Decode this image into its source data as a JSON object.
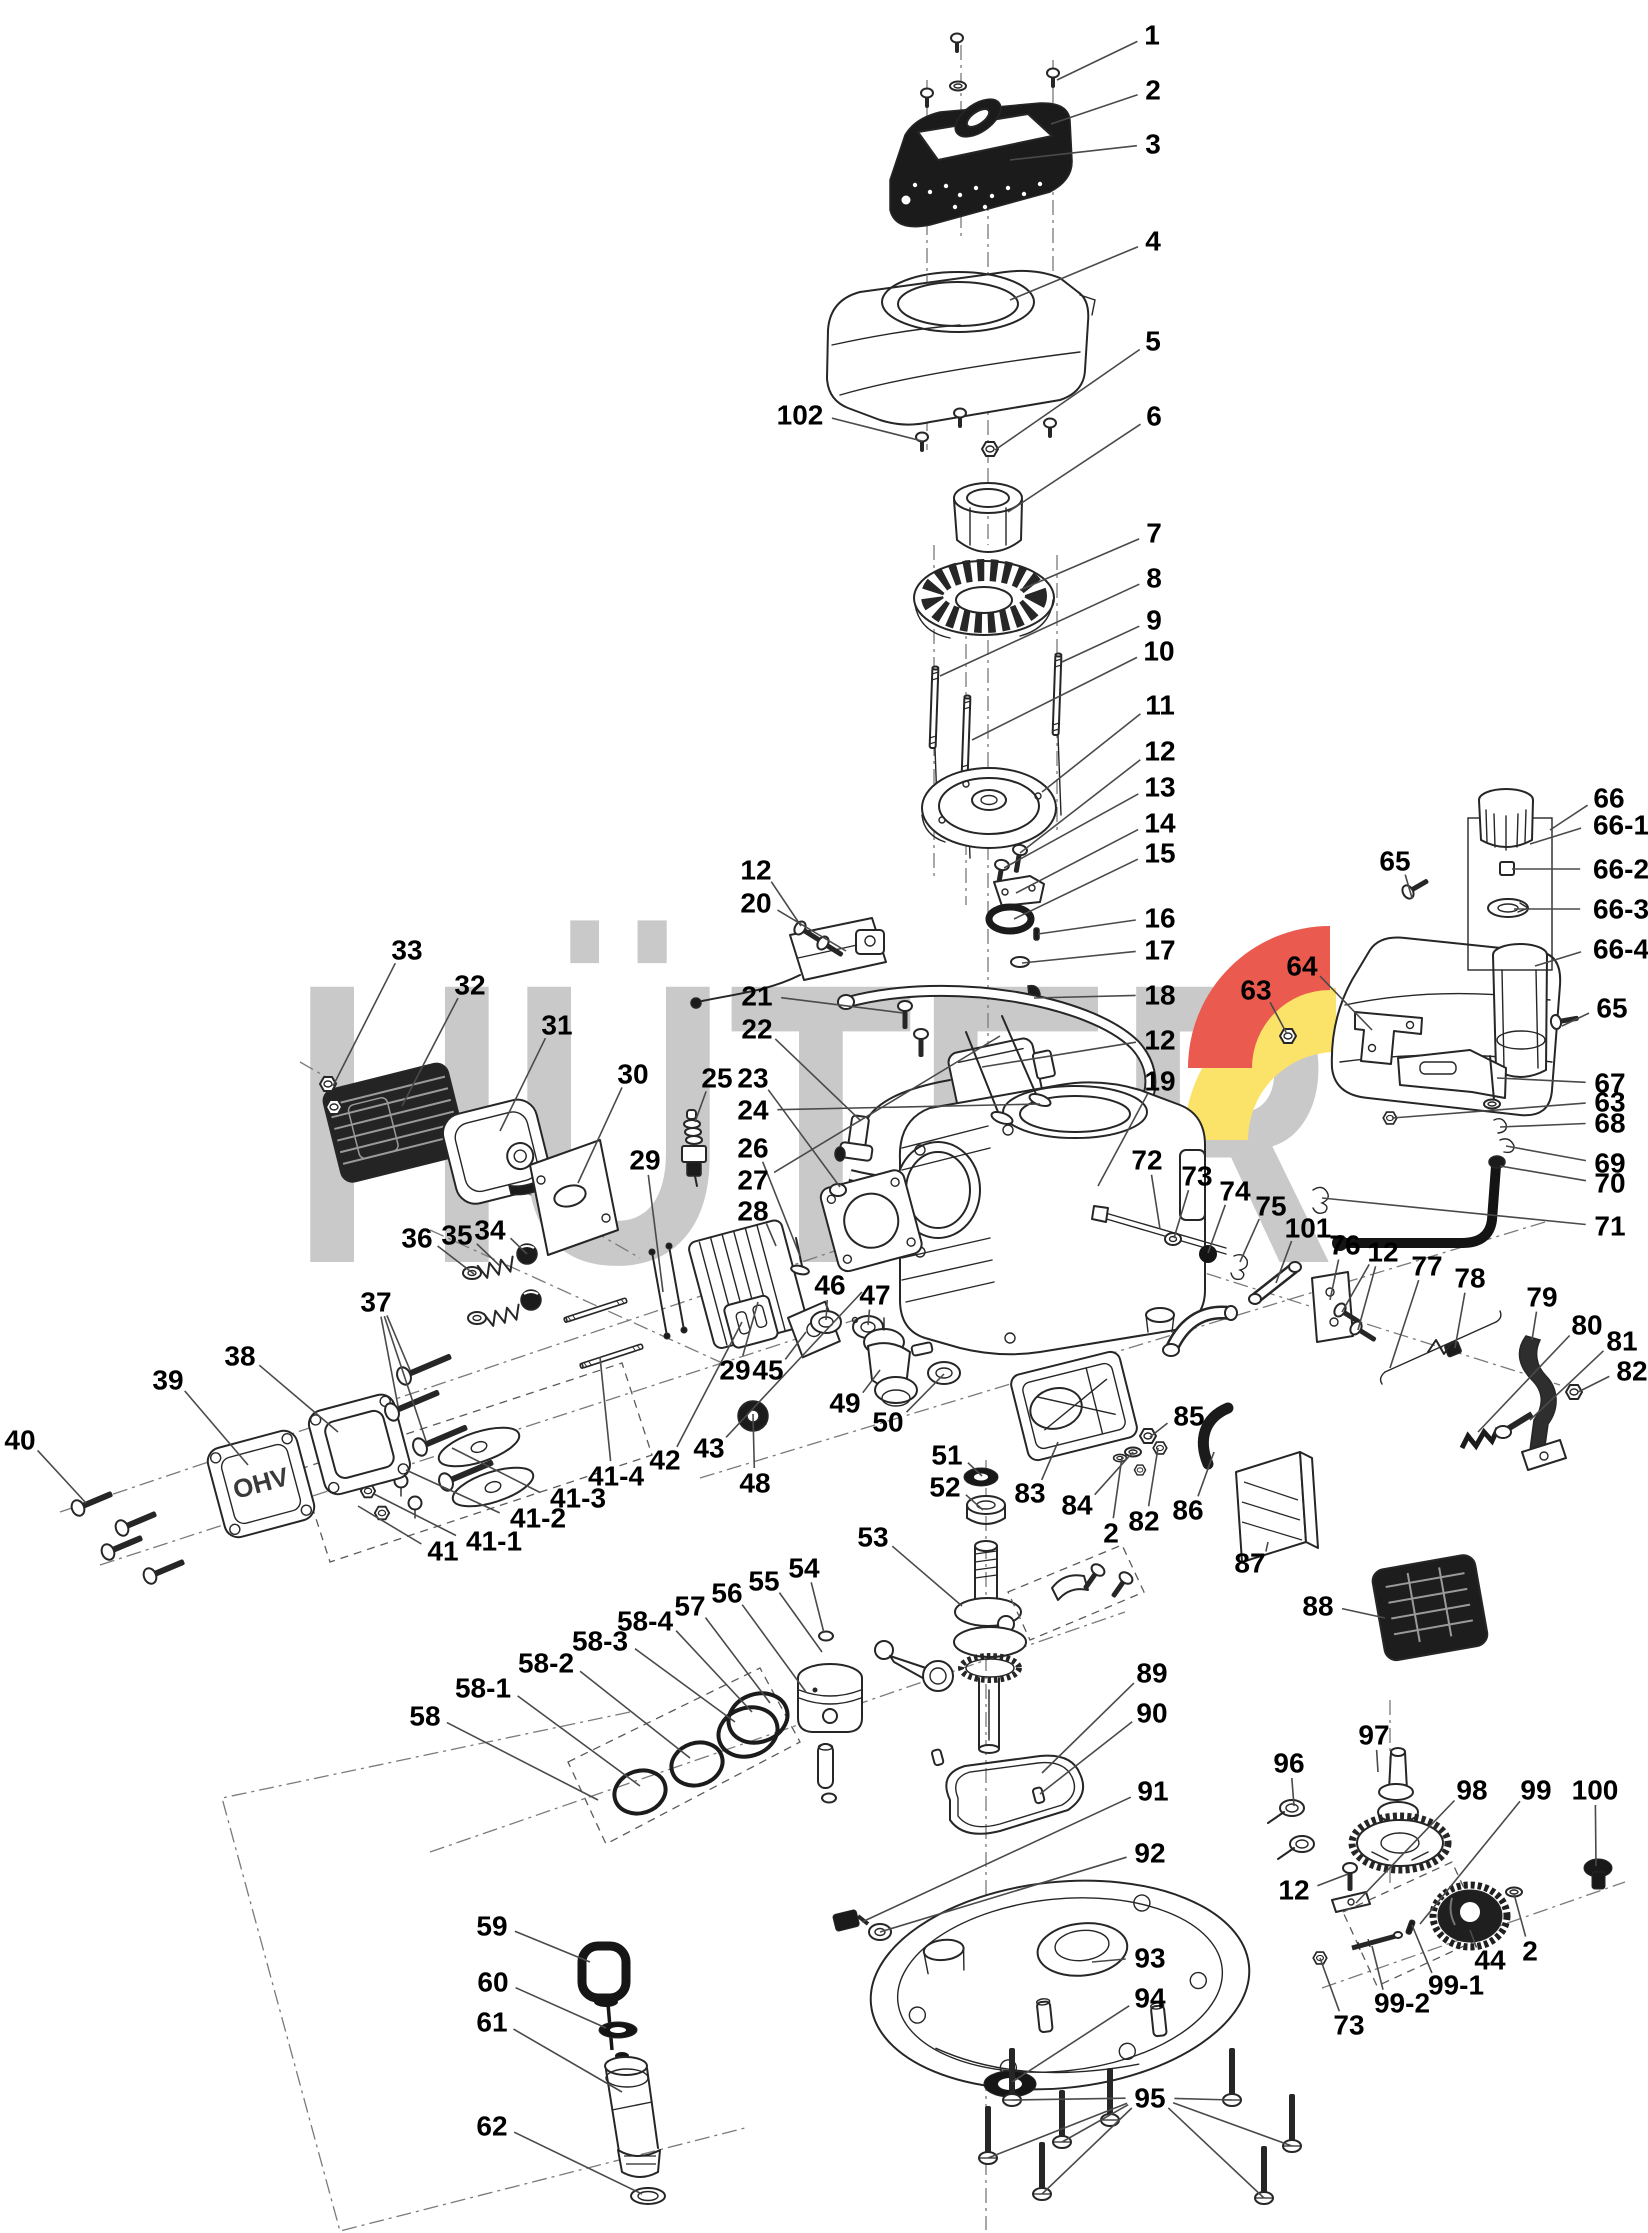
{
  "figure": {
    "type": "exploded-parts-diagram",
    "subject": "engine"
  },
  "watermark": {
    "text": "HÜTER",
    "gray": "#c9c9c9",
    "red": "#ea5a4f",
    "yellow": "#fbe36a"
  },
  "cover_emboss": "OHV",
  "callouts": [
    {
      "n": "1",
      "x": 1152,
      "y": 35,
      "t": [
        [
          1057,
          80
        ]
      ]
    },
    {
      "n": "2",
      "x": 1153,
      "y": 90,
      "t": [
        [
          1051,
          124
        ]
      ]
    },
    {
      "n": "3",
      "x": 1153,
      "y": 144,
      "t": [
        [
          1010,
          160
        ]
      ]
    },
    {
      "n": "4",
      "x": 1153,
      "y": 241,
      "t": [
        [
          1010,
          300
        ]
      ]
    },
    {
      "n": "5",
      "x": 1153,
      "y": 341,
      "t": [
        [
          995,
          450
        ]
      ]
    },
    {
      "n": "6",
      "x": 1154,
      "y": 416,
      "t": [
        [
          1008,
          512
        ]
      ]
    },
    {
      "n": "7",
      "x": 1154,
      "y": 533,
      "t": [
        [
          1020,
          590
        ]
      ]
    },
    {
      "n": "8",
      "x": 1154,
      "y": 578,
      "t": [
        [
          940,
          676
        ]
      ]
    },
    {
      "n": "9",
      "x": 1154,
      "y": 620,
      "t": [
        [
          1062,
          662
        ]
      ]
    },
    {
      "n": "10",
      "x": 1159,
      "y": 651,
      "t": [
        [
          972,
          740
        ]
      ]
    },
    {
      "n": "11",
      "x": 1160,
      "y": 705,
      "t": [
        [
          1042,
          792
        ]
      ]
    },
    {
      "n": "12",
      "x": 1160,
      "y": 751,
      "t": [
        [
          1020,
          853
        ]
      ]
    },
    {
      "n": "13",
      "x": 1160,
      "y": 787,
      "t": [
        [
          1004,
          868
        ]
      ]
    },
    {
      "n": "14",
      "x": 1160,
      "y": 823,
      "t": [
        [
          1016,
          893
        ]
      ]
    },
    {
      "n": "15",
      "x": 1160,
      "y": 853,
      "t": [
        [
          1014,
          919
        ]
      ]
    },
    {
      "n": "16",
      "x": 1160,
      "y": 918,
      "t": [
        [
          1038,
          934
        ]
      ]
    },
    {
      "n": "17",
      "x": 1160,
      "y": 950,
      "t": [
        [
          1022,
          963
        ]
      ]
    },
    {
      "n": "18",
      "x": 1160,
      "y": 995,
      "t": [
        [
          1034,
          998
        ]
      ]
    },
    {
      "n": "12",
      "x": 1160,
      "y": 1040,
      "t": [
        [
          982,
          1067
        ]
      ]
    },
    {
      "n": "19",
      "x": 1160,
      "y": 1081,
      "t": [
        [
          1098,
          1186
        ]
      ]
    },
    {
      "n": "102",
      "x": 800,
      "y": 415,
      "t": [
        [
          922,
          441
        ]
      ]
    },
    {
      "n": "33",
      "x": 407,
      "y": 950,
      "t": [
        [
          333,
          1086
        ]
      ]
    },
    {
      "n": "32",
      "x": 470,
      "y": 985,
      "t": [
        [
          402,
          1106
        ]
      ]
    },
    {
      "n": "31",
      "x": 557,
      "y": 1025,
      "t": [
        [
          500,
          1131
        ]
      ]
    },
    {
      "n": "30",
      "x": 633,
      "y": 1074,
      "t": [
        [
          578,
          1183
        ]
      ]
    },
    {
      "n": "25",
      "x": 717,
      "y": 1078,
      "t": [
        [
          695,
          1122
        ]
      ]
    },
    {
      "n": "23",
      "x": 753,
      "y": 1078,
      "t": [
        [
          840,
          1187
        ]
      ]
    },
    {
      "n": "12",
      "x": 756,
      "y": 870,
      "t": [
        [
          801,
          926
        ]
      ]
    },
    {
      "n": "20",
      "x": 756,
      "y": 903,
      "t": [
        [
          846,
          951
        ]
      ]
    },
    {
      "n": "21",
      "x": 757,
      "y": 996,
      "t": [
        [
          903,
          1013
        ]
      ]
    },
    {
      "n": "22",
      "x": 757,
      "y": 1029,
      "t": [
        [
          861,
          1121
        ]
      ]
    },
    {
      "n": "24",
      "x": 753,
      "y": 1110,
      "t": [
        [
          1040,
          1104
        ]
      ]
    },
    {
      "n": "26",
      "x": 753,
      "y": 1148,
      "t": [
        [
          800,
          1256
        ]
      ]
    },
    {
      "n": "27",
      "x": 753,
      "y": 1180,
      "t": [
        [
          1000,
          1036
        ]
      ]
    },
    {
      "n": "28",
      "x": 753,
      "y": 1211,
      "t": [
        [
          776,
          1246
        ]
      ]
    },
    {
      "n": "29",
      "x": 645,
      "y": 1160,
      "t": [
        [
          663,
          1292
        ]
      ]
    },
    {
      "n": "36",
      "x": 417,
      "y": 1238,
      "t": [
        [
          474,
          1274
        ]
      ]
    },
    {
      "n": "35",
      "x": 457,
      "y": 1235,
      "t": [
        [
          500,
          1266
        ]
      ]
    },
    {
      "n": "34",
      "x": 490,
      "y": 1230,
      "t": [
        [
          527,
          1254
        ]
      ]
    },
    {
      "n": "37",
      "x": 376,
      "y": 1302,
      "t": [
        [
          410,
          1370
        ],
        [
          398,
          1406
        ],
        [
          426,
          1441
        ]
      ]
    },
    {
      "n": "38",
      "x": 240,
      "y": 1356,
      "t": [
        [
          338,
          1432
        ]
      ]
    },
    {
      "n": "39",
      "x": 168,
      "y": 1380,
      "t": [
        [
          248,
          1465
        ]
      ]
    },
    {
      "n": "40",
      "x": 20,
      "y": 1440,
      "t": [
        [
          86,
          1503
        ]
      ]
    },
    {
      "n": "41",
      "x": 443,
      "y": 1551,
      "t": [
        [
          358,
          1506
        ]
      ]
    },
    {
      "n": "41-1",
      "x": 494,
      "y": 1541,
      "t": [
        [
          374,
          1494
        ]
      ]
    },
    {
      "n": "41-2",
      "x": 538,
      "y": 1518,
      "t": [
        [
          406,
          1470
        ]
      ]
    },
    {
      "n": "41-3",
      "x": 578,
      "y": 1498,
      "t": [
        [
          452,
          1448
        ]
      ]
    },
    {
      "n": "41-4",
      "x": 616,
      "y": 1476,
      "t": [
        [
          600,
          1357
        ]
      ]
    },
    {
      "n": "42",
      "x": 665,
      "y": 1460,
      "t": [
        [
          742,
          1322
        ]
      ]
    },
    {
      "n": "43",
      "x": 709,
      "y": 1448,
      "t": [
        [
          862,
          1292
        ]
      ]
    },
    {
      "n": "29",
      "x": 735,
      "y": 1370,
      "t": [
        [
          758,
          1302
        ]
      ]
    },
    {
      "n": "45",
      "x": 768,
      "y": 1370,
      "t": [
        [
          806,
          1332
        ]
      ]
    },
    {
      "n": "46",
      "x": 830,
      "y": 1285,
      "t": [
        [
          826,
          1320
        ]
      ]
    },
    {
      "n": "47",
      "x": 875,
      "y": 1295,
      "t": [
        [
          868,
          1325
        ]
      ]
    },
    {
      "n": "48",
      "x": 755,
      "y": 1483,
      "t": [
        [
          753,
          1414
        ]
      ]
    },
    {
      "n": "49",
      "x": 845,
      "y": 1403,
      "t": [
        [
          880,
          1370
        ]
      ]
    },
    {
      "n": "50",
      "x": 888,
      "y": 1422,
      "t": [
        [
          944,
          1374
        ]
      ]
    },
    {
      "n": "51",
      "x": 947,
      "y": 1455,
      "t": [
        [
          982,
          1476
        ]
      ]
    },
    {
      "n": "52",
      "x": 945,
      "y": 1487,
      "t": [
        [
          983,
          1510
        ]
      ]
    },
    {
      "n": "53",
      "x": 873,
      "y": 1537,
      "t": [
        [
          962,
          1606
        ]
      ]
    },
    {
      "n": "54",
      "x": 804,
      "y": 1568,
      "t": [
        [
          824,
          1633
        ]
      ]
    },
    {
      "n": "55",
      "x": 764,
      "y": 1581,
      "t": [
        [
          822,
          1652
        ]
      ]
    },
    {
      "n": "56",
      "x": 727,
      "y": 1593,
      "t": [
        [
          806,
          1692
        ]
      ]
    },
    {
      "n": "57",
      "x": 690,
      "y": 1606,
      "t": [
        [
          770,
          1703
        ]
      ]
    },
    {
      "n": "58-4",
      "x": 645,
      "y": 1621,
      "t": [
        [
          752,
          1712
        ]
      ]
    },
    {
      "n": "58-3",
      "x": 600,
      "y": 1641,
      "t": [
        [
          735,
          1722
        ]
      ]
    },
    {
      "n": "58-2",
      "x": 546,
      "y": 1663,
      "t": [
        [
          690,
          1758
        ]
      ]
    },
    {
      "n": "58-1",
      "x": 483,
      "y": 1688,
      "t": [
        [
          640,
          1786
        ]
      ]
    },
    {
      "n": "58",
      "x": 425,
      "y": 1716,
      "t": [
        [
          598,
          1800
        ]
      ]
    },
    {
      "n": "59",
      "x": 492,
      "y": 1926,
      "t": [
        [
          590,
          1962
        ]
      ]
    },
    {
      "n": "60",
      "x": 493,
      "y": 1982,
      "t": [
        [
          606,
          2028
        ]
      ]
    },
    {
      "n": "61",
      "x": 492,
      "y": 2022,
      "t": [
        [
          622,
          2092
        ]
      ]
    },
    {
      "n": "62",
      "x": 492,
      "y": 2126,
      "t": [
        [
          642,
          2194
        ]
      ]
    },
    {
      "n": "63",
      "x": 1256,
      "y": 990,
      "t": [
        [
          1287,
          1034
        ]
      ]
    },
    {
      "n": "64",
      "x": 1302,
      "y": 966,
      "t": [
        [
          1372,
          1030
        ]
      ]
    },
    {
      "n": "65",
      "x": 1395,
      "y": 861,
      "t": [
        [
          1412,
          898
        ]
      ]
    },
    {
      "n": "66",
      "x": 1609,
      "y": 798,
      "t": [
        [
          1550,
          830
        ]
      ]
    },
    {
      "n": "66-1",
      "x": 1621,
      "y": 825,
      "t": [
        [
          1530,
          844
        ]
      ]
    },
    {
      "n": "66-2",
      "x": 1621,
      "y": 869,
      "t": [
        [
          1512,
          869
        ]
      ]
    },
    {
      "n": "66-3",
      "x": 1621,
      "y": 909,
      "t": [
        [
          1514,
          909
        ]
      ]
    },
    {
      "n": "66-4",
      "x": 1621,
      "y": 949,
      "t": [
        [
          1535,
          966
        ]
      ]
    },
    {
      "n": "65",
      "x": 1612,
      "y": 1008,
      "t": [
        [
          1562,
          1026
        ]
      ]
    },
    {
      "n": "67",
      "x": 1610,
      "y": 1083,
      "t": [
        [
          1497,
          1078
        ]
      ]
    },
    {
      "n": "63",
      "x": 1610,
      "y": 1102,
      "t": [
        [
          1392,
          1118
        ]
      ]
    },
    {
      "n": "68",
      "x": 1610,
      "y": 1123,
      "t": [
        [
          1500,
          1127
        ]
      ]
    },
    {
      "n": "69",
      "x": 1610,
      "y": 1163,
      "t": [
        [
          1506,
          1146
        ]
      ]
    },
    {
      "n": "70",
      "x": 1610,
      "y": 1183,
      "t": [
        [
          1500,
          1166
        ]
      ]
    },
    {
      "n": "71",
      "x": 1610,
      "y": 1226,
      "t": [
        [
          1322,
          1198
        ]
      ]
    },
    {
      "n": "72",
      "x": 1147,
      "y": 1160,
      "t": [
        [
          1160,
          1229
        ]
      ]
    },
    {
      "n": "73",
      "x": 1197,
      "y": 1176,
      "t": [
        [
          1174,
          1238
        ]
      ]
    },
    {
      "n": "74",
      "x": 1235,
      "y": 1191,
      "t": [
        [
          1208,
          1253
        ]
      ]
    },
    {
      "n": "75",
      "x": 1271,
      "y": 1206,
      "t": [
        [
          1240,
          1262
        ]
      ]
    },
    {
      "n": "101",
      "x": 1308,
      "y": 1228,
      "t": [
        [
          1276,
          1283
        ]
      ]
    },
    {
      "n": "76",
      "x": 1345,
      "y": 1245,
      "t": [
        [
          1330,
          1300
        ]
      ]
    },
    {
      "n": "12",
      "x": 1383,
      "y": 1252,
      "t": [
        [
          1342,
          1312
        ],
        [
          1358,
          1330
        ]
      ]
    },
    {
      "n": "77",
      "x": 1427,
      "y": 1266,
      "t": [
        [
          1390,
          1368
        ]
      ]
    },
    {
      "n": "78",
      "x": 1470,
      "y": 1278,
      "t": [
        [
          1455,
          1348
        ]
      ]
    },
    {
      "n": "79",
      "x": 1542,
      "y": 1297,
      "t": [
        [
          1532,
          1340
        ]
      ]
    },
    {
      "n": "80",
      "x": 1587,
      "y": 1325,
      "t": [
        [
          1478,
          1432
        ]
      ]
    },
    {
      "n": "81",
      "x": 1622,
      "y": 1341,
      "t": [
        [
          1530,
          1420
        ]
      ]
    },
    {
      "n": "82",
      "x": 1632,
      "y": 1371,
      "t": [
        [
          1578,
          1392
        ]
      ]
    },
    {
      "n": "83",
      "x": 1030,
      "y": 1493,
      "t": [
        [
          1058,
          1442
        ]
      ]
    },
    {
      "n": "84",
      "x": 1077,
      "y": 1505,
      "t": [
        [
          1133,
          1452
        ]
      ]
    },
    {
      "n": "2",
      "x": 1111,
      "y": 1533,
      "t": [
        [
          1122,
          1457
        ]
      ]
    },
    {
      "n": "82",
      "x": 1144,
      "y": 1521,
      "t": [
        [
          1158,
          1448
        ]
      ]
    },
    {
      "n": "85",
      "x": 1189,
      "y": 1416,
      "t": [
        [
          1150,
          1437
        ]
      ]
    },
    {
      "n": "86",
      "x": 1188,
      "y": 1510,
      "t": [
        [
          1214,
          1452
        ]
      ]
    },
    {
      "n": "87",
      "x": 1250,
      "y": 1563,
      "t": [
        [
          1268,
          1542
        ]
      ]
    },
    {
      "n": "88",
      "x": 1318,
      "y": 1606,
      "t": [
        [
          1385,
          1618
        ]
      ]
    },
    {
      "n": "89",
      "x": 1152,
      "y": 1673,
      "t": [
        [
          1042,
          1773
        ]
      ]
    },
    {
      "n": "90",
      "x": 1152,
      "y": 1713,
      "t": [
        [
          1040,
          1794
        ]
      ]
    },
    {
      "n": "91",
      "x": 1153,
      "y": 1791,
      "t": [
        [
          862,
          1922
        ]
      ]
    },
    {
      "n": "92",
      "x": 1150,
      "y": 1853,
      "t": [
        [
          880,
          1932
        ]
      ]
    },
    {
      "n": "93",
      "x": 1150,
      "y": 1958,
      "t": [
        [
          1092,
          1962
        ]
      ]
    },
    {
      "n": "94",
      "x": 1150,
      "y": 1998,
      "t": [
        [
          1012,
          2082
        ]
      ]
    },
    {
      "n": "95",
      "x": 1150,
      "y": 2098,
      "t": [
        [
          1012,
          2100
        ],
        [
          988,
          2158
        ],
        [
          1062,
          2142
        ],
        [
          1042,
          2194
        ],
        [
          1232,
          2100
        ],
        [
          1292,
          2146
        ],
        [
          1264,
          2198
        ]
      ]
    },
    {
      "n": "96",
      "x": 1289,
      "y": 1763,
      "t": [
        [
          1294,
          1806
        ]
      ]
    },
    {
      "n": "97",
      "x": 1374,
      "y": 1735,
      "t": [
        [
          1378,
          1772
        ]
      ]
    },
    {
      "n": "98",
      "x": 1472,
      "y": 1790,
      "t": [
        [
          1356,
          1903
        ]
      ]
    },
    {
      "n": "99",
      "x": 1536,
      "y": 1790,
      "t": [
        [
          1420,
          1924
        ]
      ]
    },
    {
      "n": "100",
      "x": 1595,
      "y": 1790,
      "t": [
        [
          1596,
          1866
        ]
      ]
    },
    {
      "n": "12",
      "x": 1294,
      "y": 1890,
      "t": [
        [
          1348,
          1874
        ]
      ]
    },
    {
      "n": "44",
      "x": 1490,
      "y": 1960,
      "t": [
        [
          1470,
          1930
        ]
      ]
    },
    {
      "n": "2",
      "x": 1530,
      "y": 1951,
      "t": [
        [
          1514,
          1894
        ]
      ]
    },
    {
      "n": "99-1",
      "x": 1456,
      "y": 1985,
      "t": [
        [
          1412,
          1925
        ]
      ]
    },
    {
      "n": "99-2",
      "x": 1402,
      "y": 2003,
      "t": [
        [
          1372,
          1946
        ]
      ]
    },
    {
      "n": "73",
      "x": 1349,
      "y": 2025,
      "t": [
        [
          1320,
          1958
        ]
      ]
    }
  ]
}
